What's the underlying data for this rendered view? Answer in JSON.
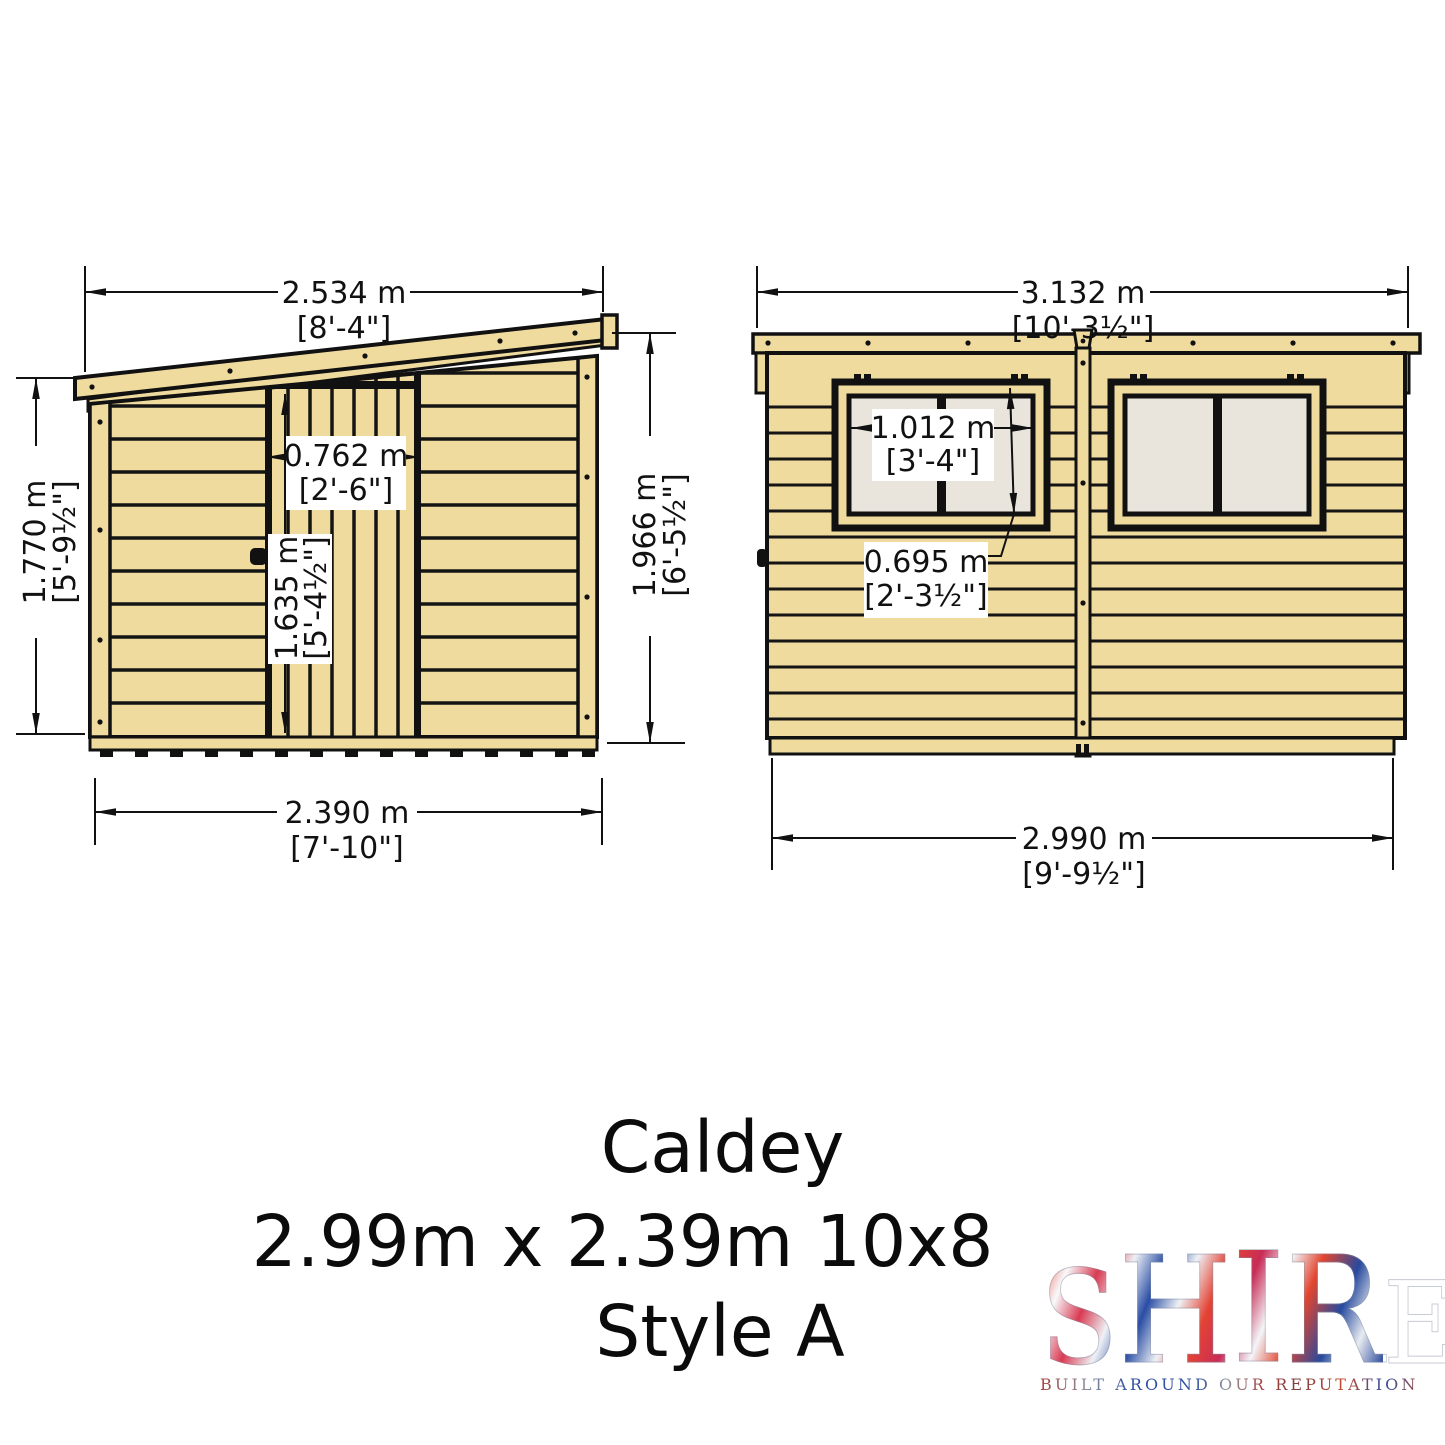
{
  "front_view": {
    "label": "front elevation with door",
    "dim_top": {
      "metric": "2.534 m",
      "imperial": "[8'-4\"]"
    },
    "dim_left": {
      "metric": "1.770 m",
      "imperial": "[5'-9½\"]"
    },
    "dim_right": {
      "metric": "1.966 m",
      "imperial": "[6'-5½\"]"
    },
    "dim_bottom": {
      "metric": "2.390 m",
      "imperial": "[7'-10\"]"
    },
    "dim_door_width": {
      "metric": "0.762 m",
      "imperial": "[2'-6\"]"
    },
    "dim_door_height": {
      "metric": "1.635 m",
      "imperial": "[5'-4½\"]"
    }
  },
  "side_view": {
    "label": "side elevation with two windows",
    "dim_top": {
      "metric": "3.132 m",
      "imperial": "[10'-3½\"]"
    },
    "dim_bottom": {
      "metric": "2.990 m",
      "imperial": "[9'-9½\"]"
    },
    "dim_window_width": {
      "metric": "1.012 m",
      "imperial": "[3'-4\"]"
    },
    "dim_window_height": {
      "metric": "0.695 m",
      "imperial": "[2'-3½\"]"
    }
  },
  "caption": {
    "product_name": "Caldey",
    "size_line": "2.99m x 2.39m 10x8",
    "style_line": "Style A"
  },
  "logo": {
    "brand": "SHIRE",
    "letters": [
      "S",
      "H",
      "I",
      "R",
      "E"
    ],
    "tagline": "BUILT AROUND OUR REPUTATION"
  },
  "colors": {
    "wood": "#f0db9e",
    "outline": "#111111",
    "pane": "#e9e5dc",
    "label_bg": "#ffffff",
    "logo_red": "#d8402f",
    "logo_blue": "#2a4da5"
  }
}
